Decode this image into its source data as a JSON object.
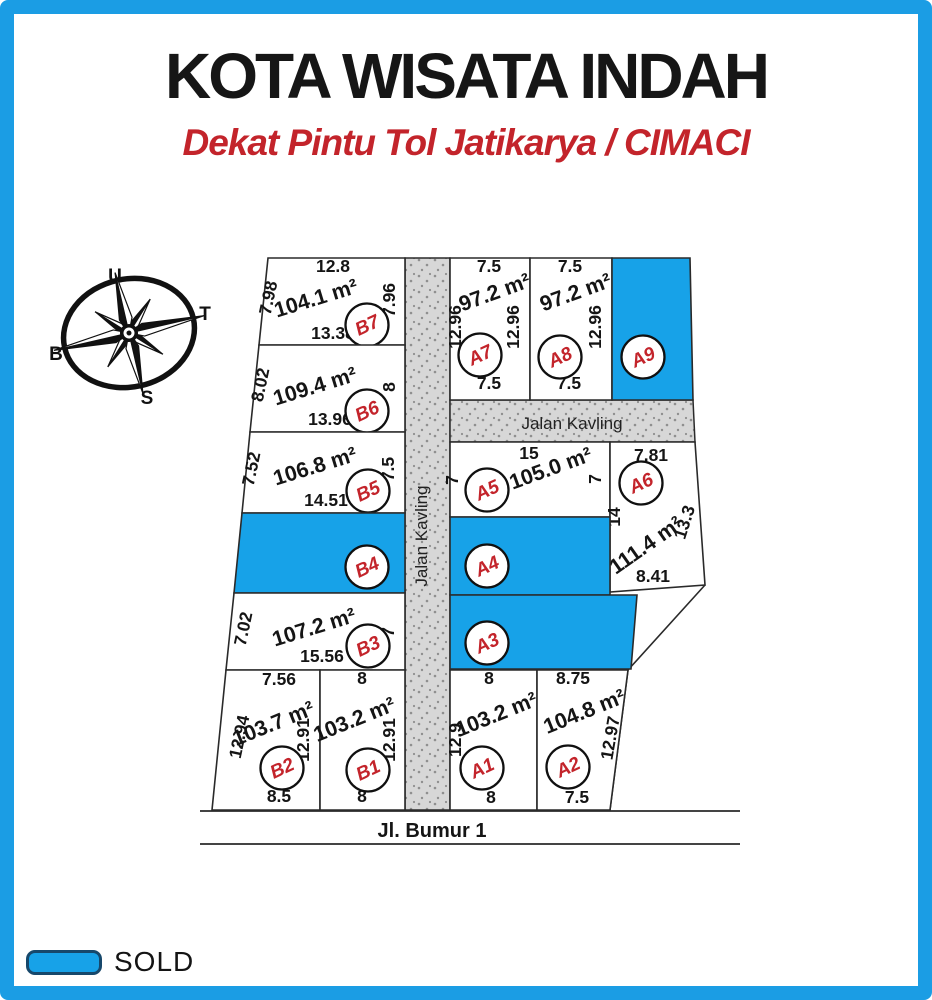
{
  "page": {
    "frame_color": "#1b9de4",
    "background": "#ffffff"
  },
  "header": {
    "title": "KOTA WISATA INDAH",
    "subtitle": "Dekat Pintu Tol Jatikarya / CIMACI",
    "title_color": "#161616",
    "subtitle_color": "#c3242b"
  },
  "compass": {
    "letters": [
      {
        "t": "U",
        "x": 115,
        "y": 282,
        "color": "#c3242b"
      },
      {
        "t": "T",
        "x": 205,
        "y": 320,
        "color": "#111111"
      },
      {
        "t": "B",
        "x": 56,
        "y": 360,
        "color": "#111111"
      },
      {
        "t": "S",
        "x": 147,
        "y": 404,
        "color": "#111111"
      }
    ]
  },
  "legend": {
    "label": "SOLD",
    "swatch_color": "#17a2e8"
  },
  "site_plan": {
    "sold_color": "#17a2e8",
    "plot_fill": "#ffffff",
    "line_color": "#2a2a2a",
    "road_fill": "#d7d7d7",
    "badge": {
      "fill": "#ffffff",
      "stroke": "#101010",
      "text_color": "#c3242b"
    },
    "roads": [
      {
        "name": "Jalan Kavling",
        "orientation": "vertical",
        "poly": [
          [
            405,
            258
          ],
          [
            450,
            258
          ],
          [
            450,
            810
          ],
          [
            405,
            810
          ]
        ],
        "label_x": 427,
        "label_y": 536,
        "rot": -90
      },
      {
        "name": "Jalan Kavling",
        "orientation": "horizontal",
        "poly": [
          [
            450,
            400
          ],
          [
            693,
            400
          ],
          [
            695,
            442
          ],
          [
            450,
            442
          ]
        ],
        "label_x": 572,
        "label_y": 429,
        "rot": 0
      }
    ],
    "street": {
      "name": "Jl. Bumur 1",
      "label_x": 432,
      "label_y": 837,
      "lines": [
        [
          200,
          811,
          740,
          811
        ],
        [
          200,
          844,
          740,
          844
        ]
      ]
    },
    "boundary": [
      [
        705,
        585
      ],
      [
        628,
        670
      ],
      [
        610,
        810
      ]
    ],
    "plots": [
      {
        "id": "B7",
        "sold": false,
        "area_m2": 104.1,
        "poly": [
          [
            268,
            258
          ],
          [
            405,
            258
          ],
          [
            405,
            345
          ],
          [
            259,
            345
          ]
        ],
        "badge": [
          367,
          325
        ],
        "labels": [
          {
            "t": "12.8",
            "x": 333,
            "y": 272,
            "r": 0,
            "k": "dim"
          },
          {
            "t": "104.1 m²",
            "x": 318,
            "y": 305,
            "r": -17,
            "k": "area"
          },
          {
            "t": "7.98",
            "x": 274,
            "y": 299,
            "r": -78,
            "k": "dim"
          },
          {
            "t": "7.96",
            "x": 395,
            "y": 300,
            "r": -90,
            "k": "dim"
          },
          {
            "t": "13.38",
            "x": 333,
            "y": 339,
            "r": 0,
            "k": "dim"
          }
        ]
      },
      {
        "id": "B6",
        "sold": false,
        "area_m2": 109.4,
        "poly": [
          [
            259,
            345
          ],
          [
            405,
            345
          ],
          [
            405,
            432
          ],
          [
            250,
            432
          ]
        ],
        "badge": [
          367,
          411
        ],
        "labels": [
          {
            "t": "109.4 m²",
            "x": 317,
            "y": 393,
            "r": -17,
            "k": "area"
          },
          {
            "t": "8.02",
            "x": 266,
            "y": 386,
            "r": -78,
            "k": "dim"
          },
          {
            "t": "8",
            "x": 395,
            "y": 387,
            "r": -90,
            "k": "dim"
          },
          {
            "t": "13.96",
            "x": 330,
            "y": 425,
            "r": 0,
            "k": "dim"
          }
        ]
      },
      {
        "id": "B5",
        "sold": false,
        "area_m2": 106.8,
        "poly": [
          [
            250,
            432
          ],
          [
            405,
            432
          ],
          [
            405,
            513
          ],
          [
            242,
            513
          ]
        ],
        "badge": [
          368,
          491
        ],
        "labels": [
          {
            "t": "106.8 m²",
            "x": 317,
            "y": 473,
            "r": -17,
            "k": "area"
          },
          {
            "t": "7.52",
            "x": 257,
            "y": 470,
            "r": -78,
            "k": "dim"
          },
          {
            "t": "7.5",
            "x": 394,
            "y": 469,
            "r": -90,
            "k": "dim"
          },
          {
            "t": "14.51",
            "x": 326,
            "y": 506,
            "r": 0,
            "k": "dim"
          }
        ]
      },
      {
        "id": "B4",
        "sold": true,
        "poly": [
          [
            242,
            513
          ],
          [
            405,
            513
          ],
          [
            405,
            593
          ],
          [
            234,
            593
          ]
        ],
        "badge": [
          367,
          567
        ],
        "labels": []
      },
      {
        "id": "B3",
        "sold": false,
        "area_m2": 107.2,
        "poly": [
          [
            234,
            593
          ],
          [
            405,
            593
          ],
          [
            405,
            670
          ],
          [
            226,
            670
          ]
        ],
        "badge": [
          368,
          646
        ],
        "labels": [
          {
            "t": "107.2 m²",
            "x": 316,
            "y": 634,
            "r": -17,
            "k": "area"
          },
          {
            "t": "7.02",
            "x": 249,
            "y": 630,
            "r": -78,
            "k": "dim"
          },
          {
            "t": "7",
            "x": 394,
            "y": 632,
            "r": -90,
            "k": "dim"
          },
          {
            "t": "15.56",
            "x": 322,
            "y": 662,
            "r": 0,
            "k": "dim"
          }
        ]
      },
      {
        "id": "B2",
        "sold": false,
        "area_m2": 103.7,
        "poly": [
          [
            226,
            670
          ],
          [
            320,
            670
          ],
          [
            320,
            810
          ],
          [
            212,
            810
          ]
        ],
        "badge": [
          282,
          768
        ],
        "labels": [
          {
            "t": "7.56",
            "x": 279,
            "y": 685,
            "r": 0,
            "k": "dim"
          },
          {
            "t": "103.7 m²",
            "x": 276,
            "y": 730,
            "r": -22,
            "k": "area"
          },
          {
            "t": "12.94",
            "x": 245,
            "y": 738,
            "r": -78,
            "k": "dim"
          },
          {
            "t": "12.91",
            "x": 309,
            "y": 740,
            "r": -90,
            "k": "dim"
          },
          {
            "t": "8.5",
            "x": 279,
            "y": 802,
            "r": 0,
            "k": "dim"
          }
        ]
      },
      {
        "id": "B1",
        "sold": false,
        "area_m2": 103.2,
        "poly": [
          [
            320,
            670
          ],
          [
            405,
            670
          ],
          [
            405,
            810
          ],
          [
            320,
            810
          ]
        ],
        "badge": [
          368,
          770
        ],
        "labels": [
          {
            "t": "8",
            "x": 362,
            "y": 684,
            "r": 0,
            "k": "dim"
          },
          {
            "t": "103.2 m²",
            "x": 357,
            "y": 726,
            "r": -22,
            "k": "area"
          },
          {
            "t": "12.91",
            "x": 395,
            "y": 740,
            "r": -90,
            "k": "dim"
          },
          {
            "t": "8",
            "x": 362,
            "y": 802,
            "r": 0,
            "k": "dim"
          }
        ]
      },
      {
        "id": "A7",
        "sold": false,
        "area_m2": 97.2,
        "poly": [
          [
            450,
            258
          ],
          [
            530,
            258
          ],
          [
            530,
            400
          ],
          [
            450,
            400
          ]
        ],
        "badge": [
          480,
          355
        ],
        "labels": [
          {
            "t": "7.5",
            "x": 489,
            "y": 272,
            "r": 0,
            "k": "dim"
          },
          {
            "t": "97.2 m²",
            "x": 497,
            "y": 299,
            "r": -20,
            "k": "area"
          },
          {
            "t": "12.96",
            "x": 461,
            "y": 327,
            "r": -90,
            "k": "dim"
          },
          {
            "t": "12.96",
            "x": 519,
            "y": 327,
            "r": -90,
            "k": "dim"
          },
          {
            "t": "7.5",
            "x": 489,
            "y": 389,
            "r": 0,
            "k": "dim"
          }
        ]
      },
      {
        "id": "A8",
        "sold": false,
        "area_m2": 97.2,
        "poly": [
          [
            530,
            258
          ],
          [
            612,
            258
          ],
          [
            612,
            400
          ],
          [
            530,
            400
          ]
        ],
        "badge": [
          560,
          357
        ],
        "labels": [
          {
            "t": "7.5",
            "x": 570,
            "y": 272,
            "r": 0,
            "k": "dim"
          },
          {
            "t": "97.2 m²",
            "x": 578,
            "y": 299,
            "r": -20,
            "k": "area"
          },
          {
            "t": "12.96",
            "x": 601,
            "y": 327,
            "r": -90,
            "k": "dim"
          },
          {
            "t": "7.5",
            "x": 569,
            "y": 389,
            "r": 0,
            "k": "dim"
          }
        ]
      },
      {
        "id": "A9",
        "sold": true,
        "poly": [
          [
            612,
            258
          ],
          [
            690,
            258
          ],
          [
            693,
            400
          ],
          [
            612,
            400
          ]
        ],
        "badge": [
          643,
          357
        ],
        "labels": []
      },
      {
        "id": "A5",
        "sold": false,
        "area_m2": 105.0,
        "poly": [
          [
            450,
            442
          ],
          [
            610,
            442
          ],
          [
            610,
            517
          ],
          [
            450,
            517
          ]
        ],
        "badge": [
          487,
          490
        ],
        "labels": [
          {
            "t": "15",
            "x": 529,
            "y": 459,
            "r": 0,
            "k": "dim"
          },
          {
            "t": "105.0 m²",
            "x": 553,
            "y": 475,
            "r": -20,
            "k": "area"
          },
          {
            "t": "7",
            "x": 458,
            "y": 480,
            "r": -90,
            "k": "dim"
          },
          {
            "t": "7",
            "x": 601,
            "y": 479,
            "r": -90,
            "k": "dim"
          }
        ]
      },
      {
        "id": "A6",
        "sold": false,
        "area_m2": 111.4,
        "poly": [
          [
            610,
            442
          ],
          [
            695,
            442
          ],
          [
            705,
            585
          ],
          [
            610,
            592
          ]
        ],
        "badge": [
          641,
          483
        ],
        "labels": [
          {
            "t": "7.81",
            "x": 651,
            "y": 461,
            "r": 0,
            "k": "dim"
          },
          {
            "t": "14",
            "x": 620,
            "y": 517,
            "r": -90,
            "k": "dim"
          },
          {
            "t": "111.4 m²",
            "x": 650,
            "y": 551,
            "r": -35,
            "k": "area"
          },
          {
            "t": "13.3",
            "x": 690,
            "y": 524,
            "r": -72,
            "k": "dim"
          },
          {
            "t": "8.41",
            "x": 653,
            "y": 582,
            "r": 0,
            "k": "dim"
          }
        ]
      },
      {
        "id": "A4",
        "sold": true,
        "poly": [
          [
            450,
            517
          ],
          [
            610,
            517
          ],
          [
            610,
            595
          ],
          [
            450,
            595
          ]
        ],
        "badge": [
          487,
          566
        ],
        "labels": []
      },
      {
        "id": "A3",
        "sold": true,
        "poly": [
          [
            450,
            595
          ],
          [
            637,
            595
          ],
          [
            631,
            669
          ],
          [
            450,
            669
          ]
        ],
        "badge": [
          487,
          643
        ],
        "labels": []
      },
      {
        "id": "A1",
        "sold": false,
        "area_m2": 103.2,
        "poly": [
          [
            450,
            670
          ],
          [
            537,
            670
          ],
          [
            537,
            810
          ],
          [
            450,
            810
          ]
        ],
        "badge": [
          482,
          768
        ],
        "labels": [
          {
            "t": "8",
            "x": 489,
            "y": 684,
            "r": 0,
            "k": "dim"
          },
          {
            "t": "103.2 m²",
            "x": 499,
            "y": 721,
            "r": -22,
            "k": "area"
          },
          {
            "t": "12.9",
            "x": 461,
            "y": 740,
            "r": -90,
            "k": "dim"
          },
          {
            "t": "8",
            "x": 491,
            "y": 803,
            "r": 0,
            "k": "dim"
          }
        ]
      },
      {
        "id": "A2",
        "sold": false,
        "area_m2": 104.8,
        "poly": [
          [
            537,
            670
          ],
          [
            628,
            670
          ],
          [
            610,
            810
          ],
          [
            537,
            810
          ]
        ],
        "badge": [
          568,
          767
        ],
        "labels": [
          {
            "t": "8.75",
            "x": 573,
            "y": 684,
            "r": 0,
            "k": "dim"
          },
          {
            "t": "104.8 m²",
            "x": 587,
            "y": 718,
            "r": -22,
            "k": "area"
          },
          {
            "t": "12.97",
            "x": 616,
            "y": 739,
            "r": -80,
            "k": "dim"
          },
          {
            "t": "7.5",
            "x": 577,
            "y": 803,
            "r": 0,
            "k": "dim"
          }
        ]
      }
    ]
  }
}
